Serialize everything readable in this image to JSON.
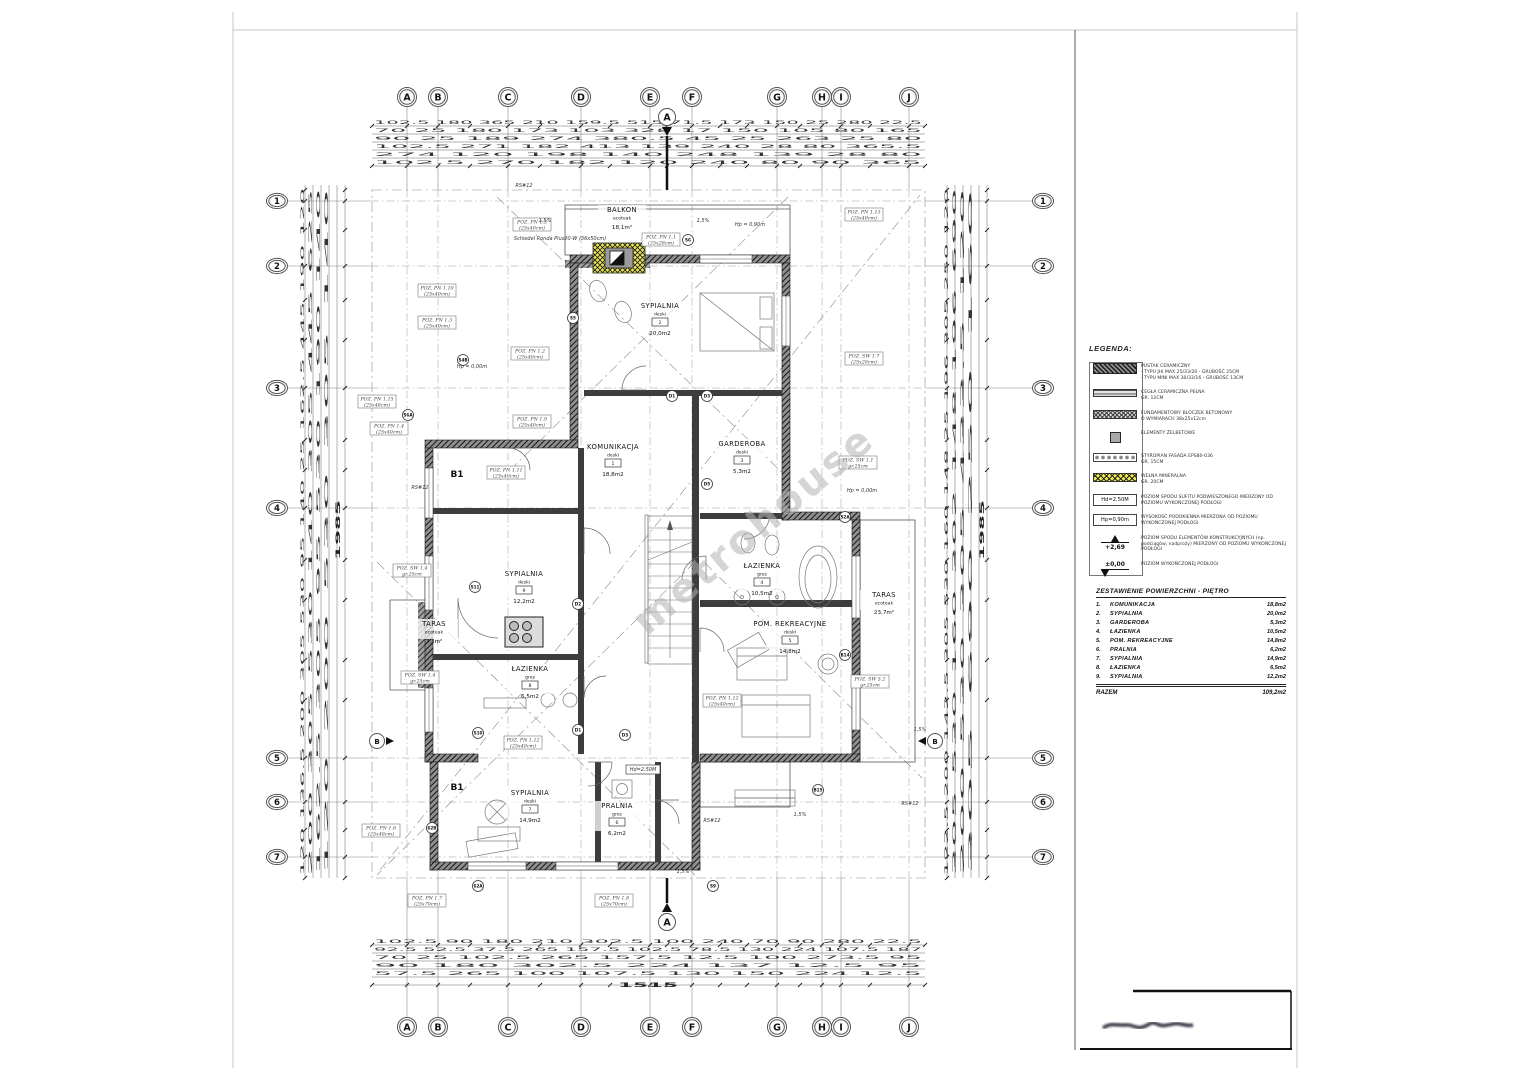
{
  "page": {
    "watermark": "metrohouse"
  },
  "grid": {
    "letters": [
      "A",
      "B",
      "C",
      "D",
      "E",
      "F",
      "G",
      "H",
      "I",
      "J"
    ],
    "letters_x": [
      407,
      438,
      508,
      581,
      650,
      692,
      777,
      822,
      841,
      909
    ],
    "top_y": 97,
    "bottom_y": 1027,
    "numbers": [
      "1",
      "2",
      "3",
      "4",
      "5",
      "6",
      "7"
    ],
    "numbers_y": [
      201,
      266,
      388,
      508,
      758,
      802,
      857
    ],
    "left_x": 277,
    "right_x": 1043,
    "section_label": "A",
    "side_section_label": "B"
  },
  "rooms": [
    {
      "name": "BALKON",
      "material": "ecoteak",
      "area": "18,1m²",
      "x": 622,
      "y": 212
    },
    {
      "name": "SYPIALNIA",
      "material": "deski",
      "num": "2",
      "area": "20,0m2",
      "x": 660,
      "y": 308
    },
    {
      "name": "KOMUNIKACJA",
      "material": "deski",
      "num": "1",
      "area": "18,8m2",
      "x": 613,
      "y": 449
    },
    {
      "name": "GARDEROBA",
      "material": "deski",
      "num": "3",
      "area": "5,3m2",
      "x": 742,
      "y": 446
    },
    {
      "name": "ŁAZIENKA",
      "material": "gres",
      "num": "4",
      "area": "10,5m2",
      "x": 762,
      "y": 568
    },
    {
      "name": "POM. REKREACYJNE",
      "material": "deski",
      "num": "5",
      "area": "14,8m2",
      "x": 790,
      "y": 626
    },
    {
      "name": "TARAS",
      "material": "ecoteak",
      "area": "23,7m²",
      "x": 884,
      "y": 597
    },
    {
      "name": "SYPIALNIA",
      "material": "deski",
      "num": "9",
      "area": "12,2m2",
      "x": 524,
      "y": 576
    },
    {
      "name": "TARAS",
      "material": "ecoteak",
      "area": "7,3m²",
      "x": 434,
      "y": 626
    },
    {
      "name": "ŁAZIENKA",
      "material": "gres",
      "num": "8",
      "area": "6,5m2",
      "x": 530,
      "y": 671
    },
    {
      "name": "SYPIALNIA",
      "material": "deski",
      "num": "7",
      "area": "14,9m2",
      "x": 530,
      "y": 795
    },
    {
      "name": "PRALNIA",
      "material": "gres",
      "num": "6",
      "area": "6,2m2",
      "x": 617,
      "y": 808
    }
  ],
  "markers": [
    {
      "label": "S6",
      "x": 688,
      "y": 240
    },
    {
      "label": "S5",
      "x": 573,
      "y": 318
    },
    {
      "label": "S4B",
      "x": 463,
      "y": 360
    },
    {
      "label": "S6A",
      "x": 408,
      "y": 415
    },
    {
      "label": "S11",
      "x": 475,
      "y": 587
    },
    {
      "label": "S10",
      "x": 478,
      "y": 733
    },
    {
      "label": "S2A",
      "x": 845,
      "y": 517
    },
    {
      "label": "B14",
      "x": 845,
      "y": 655
    },
    {
      "label": "B15",
      "x": 818,
      "y": 790
    },
    {
      "label": "62B",
      "x": 432,
      "y": 828
    },
    {
      "label": "62A",
      "x": 478,
      "y": 886
    },
    {
      "label": "S9",
      "x": 713,
      "y": 886
    },
    {
      "label": "D1",
      "x": 672,
      "y": 396
    },
    {
      "label": "D3",
      "x": 707,
      "y": 396
    },
    {
      "label": "D5",
      "x": 707,
      "y": 484
    },
    {
      "label": "D2",
      "x": 578,
      "y": 604
    },
    {
      "label": "D1",
      "x": 578,
      "y": 730
    },
    {
      "label": "D3",
      "x": 625,
      "y": 735
    }
  ],
  "b1_markers": [
    {
      "label": "B1",
      "x": 457,
      "y": 477
    },
    {
      "label": "B1",
      "x": 457,
      "y": 790
    }
  ],
  "poz_labels": [
    {
      "l1": "POZ. PN 1.5",
      "l2": "(25x40cm)",
      "x": 532,
      "y": 224
    },
    {
      "l1": "POZ. PN 1.1",
      "l2": "(25x28cm)",
      "x": 661,
      "y": 239
    },
    {
      "l1": "POZ. PN 1.13",
      "l2": "(25x40cm)",
      "x": 864,
      "y": 214
    },
    {
      "l1": "POZ. PN 1.10",
      "l2": "(25x40cm)",
      "x": 437,
      "y": 290
    },
    {
      "l1": "POZ. PN 1.3",
      "l2": "(25x40cm)",
      "x": 437,
      "y": 322
    },
    {
      "l1": "POZ. PN 1.2",
      "l2": "(25x40cm)",
      "x": 530,
      "y": 353
    },
    {
      "l1": "POZ. PN 1.15",
      "l2": "(25x48cm)",
      "x": 377,
      "y": 401
    },
    {
      "l1": "POZ. PN 1.4",
      "l2": "(25x40cm)",
      "x": 389,
      "y": 428
    },
    {
      "l1": "POZ. PN 1.9",
      "l2": "(25x40cm)",
      "x": 532,
      "y": 421
    },
    {
      "l1": "POZ. PN 1.11",
      "l2": "(25x40cm)",
      "x": 506,
      "y": 472
    },
    {
      "l1": "POZ. SW 1.7",
      "l2": "(25x20cm)",
      "x": 864,
      "y": 358
    },
    {
      "l1": "POZ. SW 1.1",
      "l2": "gr.25cm",
      "x": 858,
      "y": 462
    },
    {
      "l1": "POZ. SW 1.4",
      "l2": "gr.25cm",
      "x": 412,
      "y": 570
    },
    {
      "l1": "POZ. SW 1.4",
      "l2": "gr.25cm",
      "x": 420,
      "y": 677
    },
    {
      "l1": "POZ. PN 1.12",
      "l2": "(25x40cm)",
      "x": 722,
      "y": 700
    },
    {
      "l1": "POZ. SW 5.2",
      "l2": "gr.25cm",
      "x": 870,
      "y": 681
    },
    {
      "l1": "POZ. PN 1.12",
      "l2": "(25x40cm)",
      "x": 523,
      "y": 742
    },
    {
      "l1": "POZ. PN 1.6",
      "l2": "(25x48cm)",
      "x": 381,
      "y": 830
    },
    {
      "l1": "POZ. PN 1.7",
      "l2": "(25x70cm)",
      "x": 427,
      "y": 900
    },
    {
      "l1": "POZ. PN 1.8",
      "l2": "(25x70cm)",
      "x": 614,
      "y": 900
    }
  ],
  "notes": [
    {
      "text": "1,5%",
      "x": 545,
      "y": 222
    },
    {
      "text": "1,5%",
      "x": 703,
      "y": 222
    },
    {
      "text": "Schiedel Ronda Plus20-W (36x50cm)",
      "x": 560,
      "y": 240
    },
    {
      "text": "Hp = 0,90m",
      "x": 750,
      "y": 226
    },
    {
      "text": "Hp = 0,00m",
      "x": 862,
      "y": 492
    },
    {
      "text": "Hp = 0,00m",
      "x": 472,
      "y": 368
    },
    {
      "text": "Hd=2,50M",
      "x": 643,
      "y": 771,
      "boxed": true
    },
    {
      "text": "1,5%",
      "x": 800,
      "y": 816
    },
    {
      "text": "1,5%",
      "x": 683,
      "y": 873
    },
    {
      "text": "1,5%",
      "x": 920,
      "y": 731
    },
    {
      "text": "RS#12",
      "x": 524,
      "y": 187
    },
    {
      "text": "RS#12",
      "x": 420,
      "y": 489
    },
    {
      "text": "RS#12",
      "x": 910,
      "y": 805
    },
    {
      "text": "RS#12",
      "x": 712,
      "y": 822
    }
  ],
  "dims": {
    "top_rows": [
      {
        "y": 124,
        "text": "102.5  180  365  210  159.5  515  71.5  173  150  25  280  22.5"
      },
      {
        "y": 132,
        "text": "70  25  180  173  103  328  17  150  105  80  165"
      },
      {
        "y": 140,
        "text": "90  25  189  274  380.5  45  25  263  25  80"
      },
      {
        "y": 148,
        "text": "102.5  271  182  413  139  240  28  80  365.5"
      },
      {
        "y": 156,
        "text": "274  120  198  140  248  139  28  80"
      },
      {
        "y": 164,
        "text": "102.5  270  182  120  240  80  90  365"
      }
    ],
    "bottom_rows": [
      {
        "y": 943,
        "text": "102.5  90  180  210  302.5  100  240  70  90  280  22.5"
      },
      {
        "y": 951,
        "text": "92.5  52.5  37.5  265  157.5  102.5  78.5  130  224  107.5  187"
      },
      {
        "y": 959,
        "text": "70  25  102.5  265  157.5  12.5  100  273.5  95"
      },
      {
        "y": 967,
        "text": "90  180  302.5  224  137  12.5  95"
      },
      {
        "y": 975,
        "text": "57.5  265  100  107.5  130  150  224  12.5"
      },
      {
        "y": 987,
        "text": "1515",
        "len": 60,
        "cx": 648,
        "big": true
      }
    ],
    "left_rows": [
      {
        "x": 304,
        "text": "120  136.5  200  305  530  95  140  25  162.5  445  190  120"
      },
      {
        "x": 312,
        "text": "200  305  530  140  305  445  625"
      },
      {
        "x": 320,
        "text": "162.5  305  95  530  190  140"
      },
      {
        "x": 328,
        "text": "120  200  530  305  140"
      },
      {
        "x": 340,
        "text": "1985",
        "len": 60,
        "cy": 530,
        "big": true
      }
    ],
    "right_rows": [
      {
        "x": 948,
        "text": "122.5  200  142.5  305  530  160  148  25  196  305  250  120"
      },
      {
        "x": 956,
        "text": "305  530  160  302  148  196  690"
      },
      {
        "x": 964,
        "text": "200  530  305  433.5  120"
      },
      {
        "x": 972,
        "text": "305  690  250  160"
      },
      {
        "x": 984,
        "text": "1985",
        "len": 60,
        "cy": 530,
        "big": true
      }
    ]
  },
  "legend": {
    "title": "LEGENDA:",
    "items": [
      {
        "sym": "brick",
        "text": "PUSTAK CERAMICZNY\n- TYPU JHI MAX 25/33/20 - GRUBOŚĆ 25CM\n- TYPU MINI MAX 30/33/16 - GRUBOŚĆ 13CM"
      },
      {
        "sym": "fullbrick",
        "text": "CEGŁA CERAMICZNA PEŁNA\nGR. 12CM"
      },
      {
        "sym": "block",
        "text": "FUNDAMENTOWY BLOCZEK BETONOWY\nO WYMIARACH 38x25x12cm"
      },
      {
        "sym": "rc",
        "text": "ELEMENTY ŻELBETOWE"
      },
      {
        "sym": "eps",
        "text": "STYROPIAN FASADA EPS80-036\nGR. 15CM"
      },
      {
        "sym": "wool",
        "text": "WEŁNA MINERALNA\nGR. 20CM"
      },
      {
        "sym": "hd",
        "label": "Hd=2,50M",
        "text": "POZIOM SPODU SUFITU PODWIESZONEGO MIERZONY OD POZIOMU WYKOŃCZONEJ PODŁOGI"
      },
      {
        "sym": "hp",
        "label": "Hp=0,90m",
        "text": "WYSOKOŚĆ PODOKIENNA MIERZONA OD POZIOMU WYKOŃCZONEJ PODŁOGI"
      },
      {
        "sym": "lvl",
        "label": "+2,69",
        "text": "POZIOM SPODU ELEMENTÓW KONSTRUKCYJNYCH (np. podciągów, nadproży) MIERZONY OD POZIOMU WYKOŃCZONEJ PODŁOGI"
      },
      {
        "sym": "lvl0",
        "label": "±0,00",
        "text": "POZIOM WYKOŃCZONEJ PODŁOGI"
      }
    ]
  },
  "area_table": {
    "title": "ZESTAWIENIE POWIERZCHNI -  PIĘTRO",
    "rows": [
      {
        "no": "1.",
        "name": "KOMUNIKACJA",
        "area": "18,8m2"
      },
      {
        "no": "2.",
        "name": "SYPIALNIA",
        "area": "20,0m2"
      },
      {
        "no": "3.",
        "name": "GARDEROBA",
        "area": "5,3m2"
      },
      {
        "no": "4.",
        "name": "ŁAZIENKA",
        "area": "10,5m2"
      },
      {
        "no": "5.",
        "name": "POM. REKREACYJNE",
        "area": "14,8m2"
      },
      {
        "no": "6.",
        "name": "PRALNIA",
        "area": "6,2m2"
      },
      {
        "no": "7.",
        "name": "SYPIALNIA",
        "area": "14,9m2"
      },
      {
        "no": "8.",
        "name": "ŁAZIENKA",
        "area": "6,5m2"
      },
      {
        "no": "9.",
        "name": "SYPIALNIA",
        "area": "12,2m2"
      }
    ],
    "total_label": "RAZEM",
    "total_area": "109,2m2"
  }
}
